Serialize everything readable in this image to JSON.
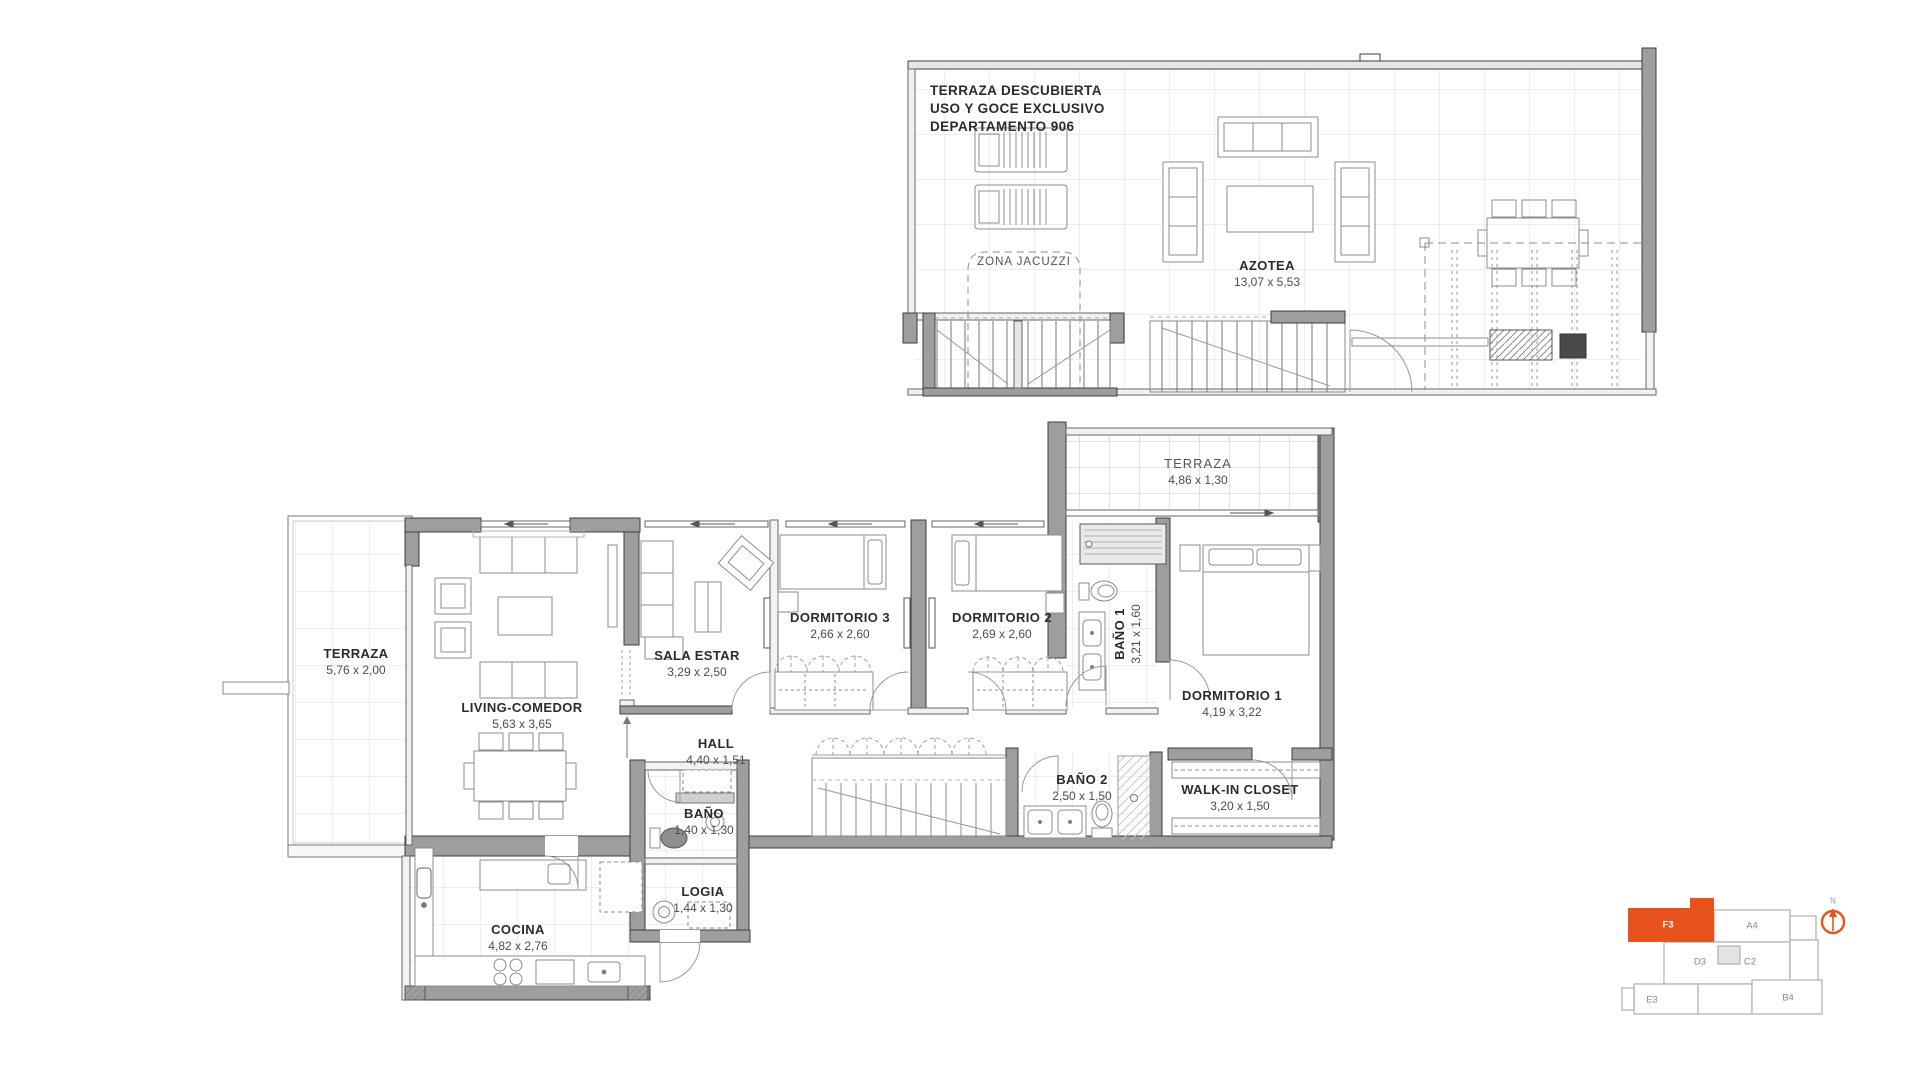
{
  "meta": {
    "accent_orange": "#e8531d",
    "wall_gray": "#9e9e9e",
    "line_dark": "#3c3c3c",
    "background": "#ffffff"
  },
  "roof_plan": {
    "title_lines": [
      "TERRAZA DESCUBIERTA",
      "USO Y GOCE EXCLUSIVO",
      "DEPARTAMENTO 906"
    ],
    "jacuzzi_label": "ZONA JACUZZI",
    "room": {
      "name": "AZOTEA",
      "dims": "13,07 x 5,53"
    }
  },
  "apartment_plan": {
    "rooms": [
      {
        "id": "terraza-left",
        "name": "TERRAZA",
        "dims": "5,76 x 2,00"
      },
      {
        "id": "living",
        "name": "LIVING-COMEDOR",
        "dims": "5,63 x 3,65"
      },
      {
        "id": "sala-estar",
        "name": "SALA ESTAR",
        "dims": "3,29 x 2,50"
      },
      {
        "id": "hall",
        "name": "HALL",
        "dims": "4,40 x 1,51"
      },
      {
        "id": "dormitorio-3",
        "name": "DORMITORIO 3",
        "dims": "2,66 x 2,60"
      },
      {
        "id": "dormitorio-2",
        "name": "DORMITORIO 2",
        "dims": "2,69 x 2,60"
      },
      {
        "id": "bano-1",
        "name": "BAÑO 1",
        "dims": "3,21 x 1,60"
      },
      {
        "id": "terraza-top",
        "name": "TERRAZA",
        "dims": "4,86 x 1,30"
      },
      {
        "id": "dormitorio-1",
        "name": "DORMITORIO 1",
        "dims": "4,19 x 3,22"
      },
      {
        "id": "bano",
        "name": "BAÑO",
        "dims": "1,40 x 1,30"
      },
      {
        "id": "bano-2",
        "name": "BAÑO 2",
        "dims": "2,50 x 1,50"
      },
      {
        "id": "walk-in-closet",
        "name": "WALK-IN CLOSET",
        "dims": "3,20 x 1,50"
      },
      {
        "id": "cocina",
        "name": "COCINA",
        "dims": "4,82 x 2,76"
      },
      {
        "id": "logia",
        "name": "LOGIA",
        "dims": "1,44 x 1,30"
      }
    ]
  },
  "key_plan": {
    "highlighted_unit": "F3",
    "units": [
      {
        "label": "F3",
        "highlighted": true
      },
      {
        "label": "A4",
        "highlighted": false
      },
      {
        "label": "D3",
        "highlighted": false
      },
      {
        "label": "C2",
        "highlighted": false
      },
      {
        "label": "E3",
        "highlighted": false
      },
      {
        "label": "B4",
        "highlighted": false
      }
    ],
    "north_label": "N"
  }
}
